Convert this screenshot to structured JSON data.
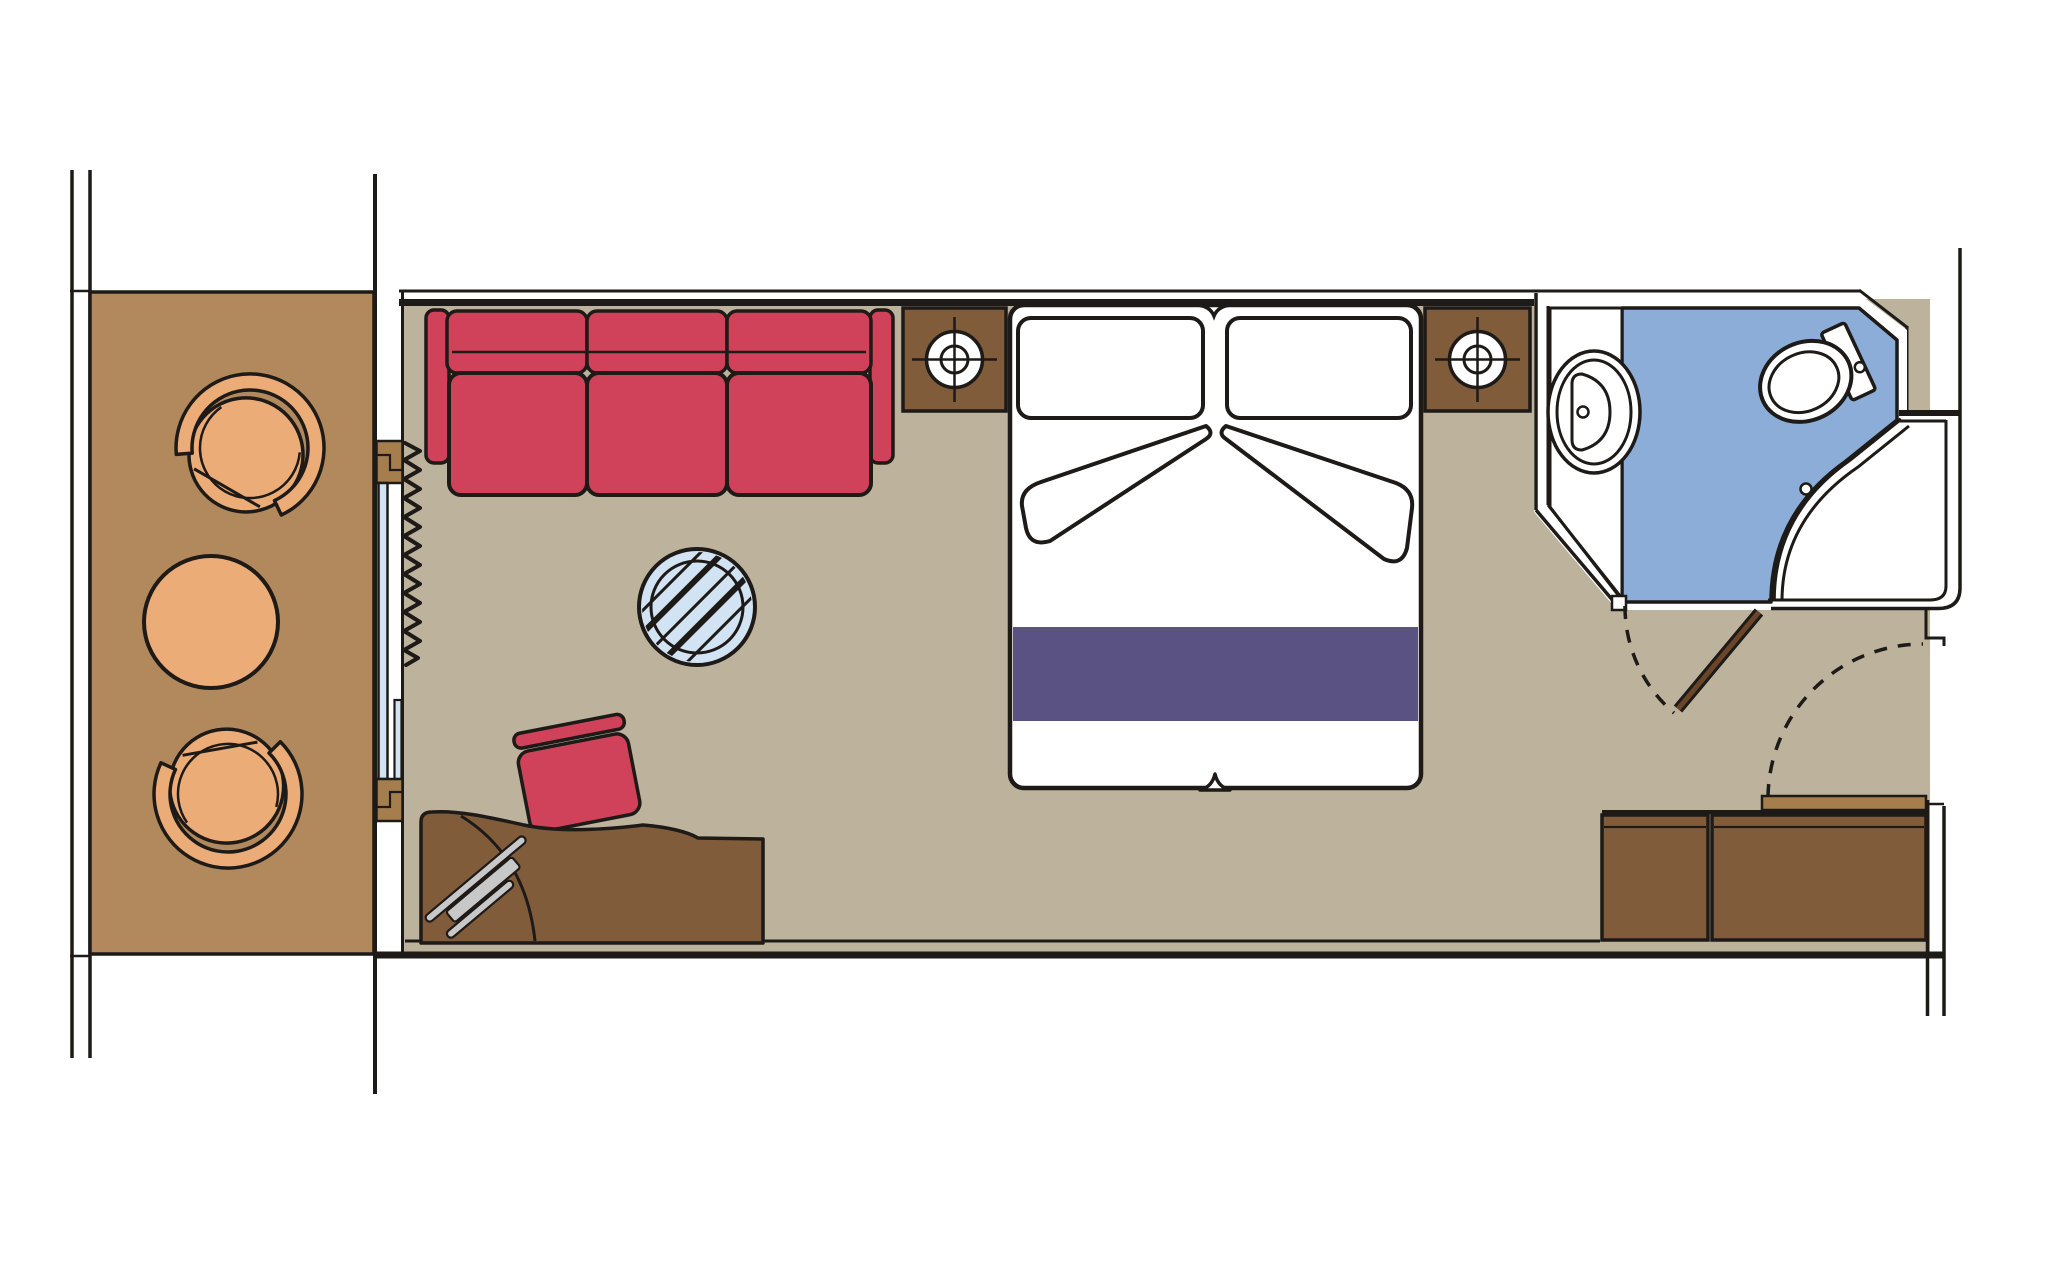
{
  "title": "Cruise ship cabin floor plan (top view)",
  "palette": {
    "line": "#1d1a17",
    "white": "#ffffff",
    "floor": "#bdb29c",
    "deck": "#b1895c",
    "chair": "#ebac78",
    "wood": "#805c3a",
    "door-frame": "#a67e4d",
    "door-leaf": "#6b4527",
    "red": "#d0425a",
    "purple": "#5a5282",
    "glass": "#d2e3f3",
    "bath-blue": "#8cadd7",
    "metal-gray": "#c8c8c8"
  },
  "rooms": [
    {
      "id": "balcony",
      "label": "Balcony"
    },
    {
      "id": "living-sleeping-area",
      "label": "Living / sleeping area"
    },
    {
      "id": "bathroom",
      "label": "Bathroom"
    },
    {
      "id": "entry",
      "label": "Entry"
    }
  ],
  "furniture": [
    {
      "id": "balcony-chair-1",
      "label": "Balcony armchair"
    },
    {
      "id": "balcony-chair-2",
      "label": "Balcony armchair"
    },
    {
      "id": "balcony-table",
      "label": "Balcony table"
    },
    {
      "id": "sliding-door",
      "label": "Sliding glass balcony door"
    },
    {
      "id": "curtain",
      "label": "Curtain"
    },
    {
      "id": "sofa",
      "label": "Three-seat sofa"
    },
    {
      "id": "round-glass-table",
      "label": "Round glass table"
    },
    {
      "id": "stool",
      "label": "Desk stool"
    },
    {
      "id": "desk",
      "label": "Desk / vanity"
    },
    {
      "id": "hair-dryer",
      "label": "Hair dryer"
    },
    {
      "id": "nightstand-left",
      "label": "Nightstand with lamp"
    },
    {
      "id": "nightstand-right",
      "label": "Nightstand with lamp"
    },
    {
      "id": "double-bed",
      "label": "Double bed"
    },
    {
      "id": "wardrobe",
      "label": "Wardrobe"
    },
    {
      "id": "entry-door",
      "label": "Entry door"
    },
    {
      "id": "bathroom-door",
      "label": "Bathroom door"
    },
    {
      "id": "washbasin",
      "label": "Washbasin"
    },
    {
      "id": "toilet",
      "label": "Toilet"
    },
    {
      "id": "shower",
      "label": "Shower"
    }
  ]
}
